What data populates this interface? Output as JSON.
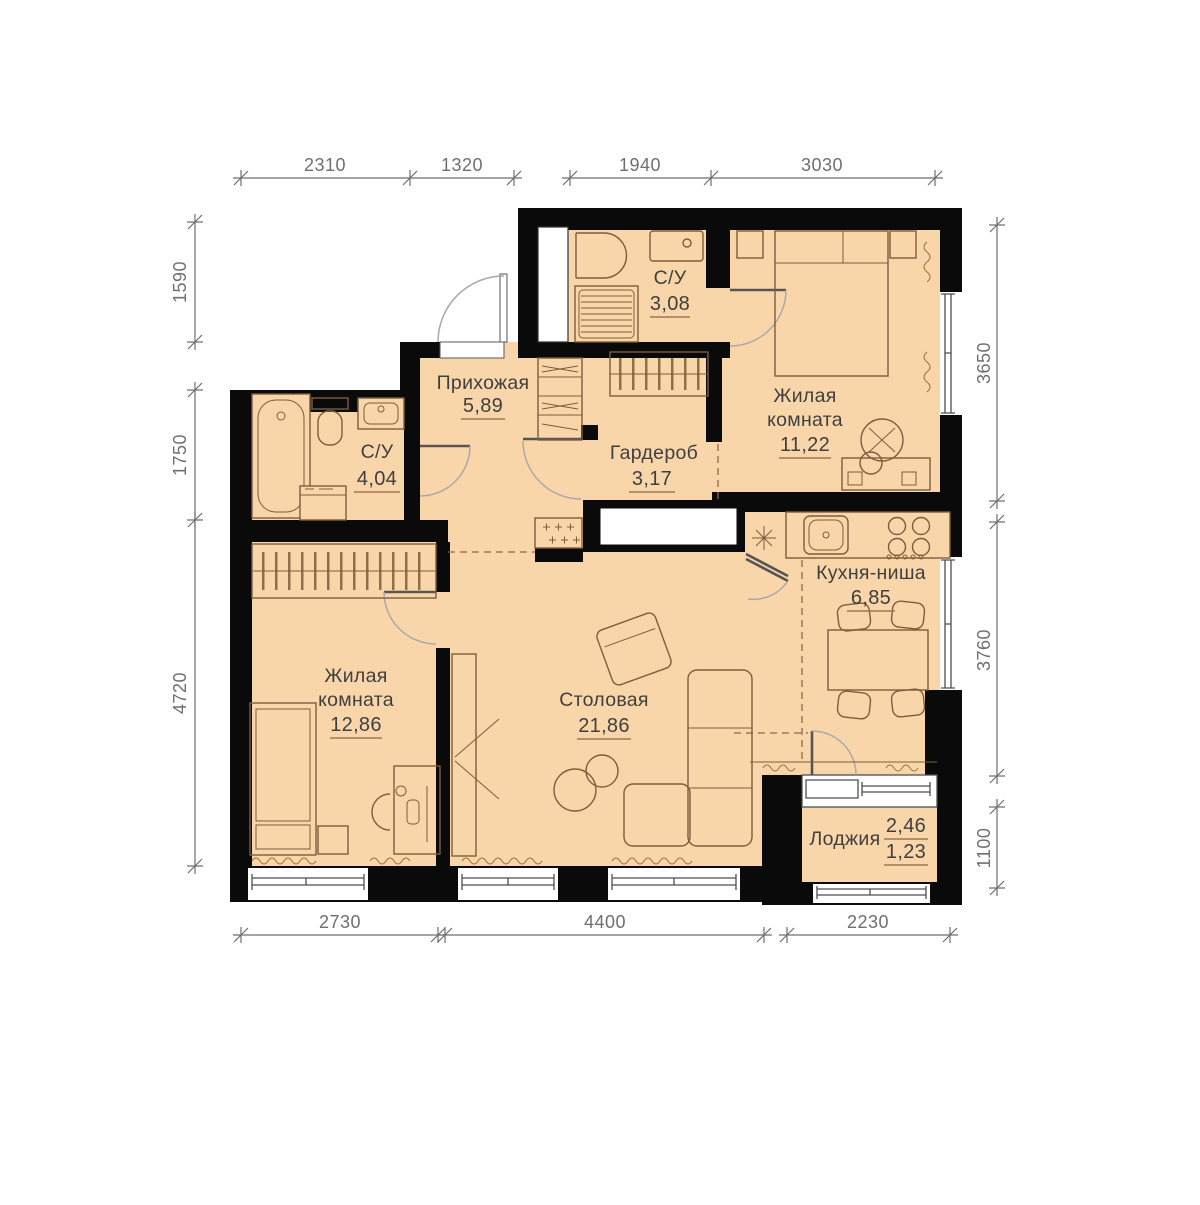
{
  "page": {
    "background": "#ffffff",
    "type": "apartment-floor-plan"
  },
  "colors": {
    "floor": "#f9d6aa",
    "wall": "#0a0a0a",
    "furniture": "#7d5d3b",
    "door_arc": "#a9a9a9",
    "dashed": "#8b6b45",
    "dimension": "#6f6f6f",
    "label": "#3f3f3f",
    "underline": "#9c7a50",
    "radiator": "#a06a35",
    "glass": "#ffffff",
    "frame": "#4d4d4d"
  },
  "rooms": [
    {
      "id": "bathroom-top",
      "name_lines": [
        "С/У"
      ],
      "area": "3,08"
    },
    {
      "id": "bedroom-top",
      "name_lines": [
        "Жилая",
        "комната"
      ],
      "area": "11,22"
    },
    {
      "id": "hallway",
      "name_lines": [
        "Прихожая"
      ],
      "area": "5,89"
    },
    {
      "id": "bathroom-left",
      "name_lines": [
        "С/У"
      ],
      "area": "4,04"
    },
    {
      "id": "wardrobe",
      "name_lines": [
        "Гардероб"
      ],
      "area": "3,17"
    },
    {
      "id": "kitchen-niche",
      "name_lines": [
        "Кухня-ниша"
      ],
      "area": "6,85"
    },
    {
      "id": "bedroom-left",
      "name_lines": [
        "Жилая",
        "комната"
      ],
      "area": "12,86"
    },
    {
      "id": "dining",
      "name_lines": [
        "Столовая"
      ],
      "area": "21,86"
    },
    {
      "id": "loggia",
      "name_lines": [
        "Лоджия"
      ],
      "area_total": "2,46",
      "area_reduced": "1,23"
    }
  ],
  "dimensions": {
    "top": [
      "2310",
      "1320",
      "1940",
      "3030"
    ],
    "left": [
      "1590",
      "1750",
      "4720"
    ],
    "right": [
      "3650",
      "3760",
      "1100"
    ],
    "bottom": [
      "2730",
      "4400",
      "2230"
    ]
  }
}
